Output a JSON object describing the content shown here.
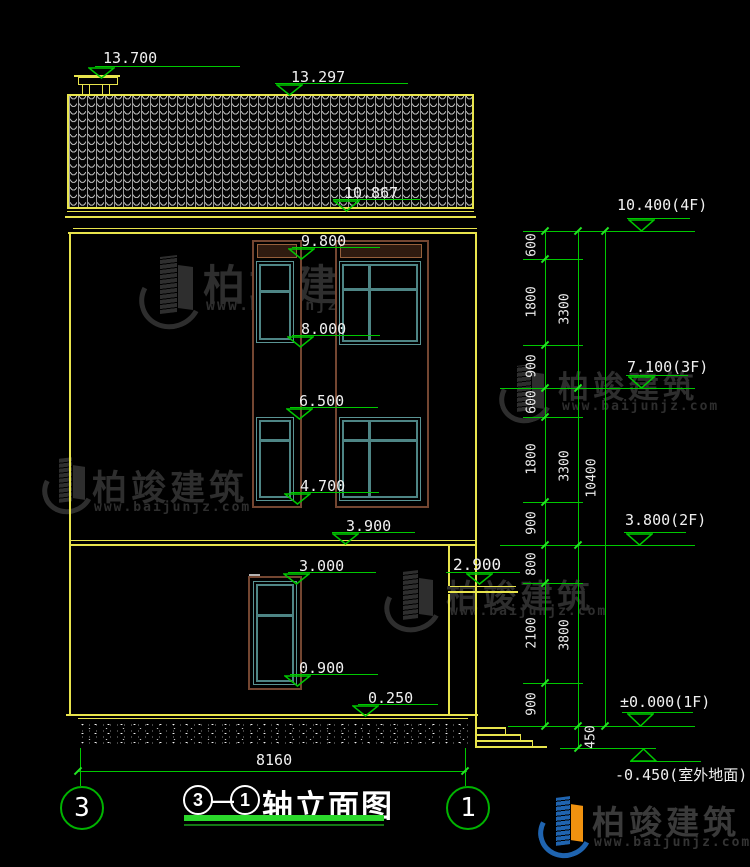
{
  "drawing": {
    "title": {
      "axis_from": "3",
      "separator": "—",
      "axis_to": "1",
      "label": "轴立面图"
    },
    "axis_bubbles": {
      "left": "3",
      "right": "1"
    },
    "overall_width_dim": "8160"
  },
  "left_levels": [
    {
      "name": "chimney-top",
      "value": "13.700"
    },
    {
      "name": "ridge",
      "value": "13.297"
    },
    {
      "name": "eave",
      "value": "10.867"
    },
    {
      "name": "window-top-3f",
      "value": "9.800"
    },
    {
      "name": "window-sill-3f",
      "value": "8.000"
    },
    {
      "name": "window-top-2f",
      "value": "6.500"
    },
    {
      "name": "window-sill-2f",
      "value": "4.700"
    },
    {
      "name": "floor-band",
      "value": "3.900"
    },
    {
      "name": "window-top-1f",
      "value": "3.000"
    },
    {
      "name": "window-sill-1f",
      "value": "0.900"
    },
    {
      "name": "plinth",
      "value": "0.250"
    },
    {
      "name": "canopy",
      "value": "2.900"
    }
  ],
  "right_levels": [
    {
      "value": "10.400(4F)"
    },
    {
      "value": "7.100(3F)"
    },
    {
      "value": "3.800(2F)"
    },
    {
      "value": "±0.000(1F)"
    },
    {
      "value": "-0.450(室外地面)"
    }
  ],
  "inner_dims": [
    "600",
    "1800",
    "900",
    "600",
    "1800",
    "900",
    "800",
    "2100",
    "900"
  ],
  "mid_dims": [
    "3300",
    "3300",
    "3800"
  ],
  "foundation_dim": "450",
  "total_dim": "10400",
  "watermark": {
    "brand": "柏竣建筑",
    "site": "www.baijunjz.com"
  },
  "footer_logo": {
    "brand": "柏竣建筑",
    "site": "www.baijunjz.com"
  },
  "icons": {
    "level-triangle-down": "▽",
    "level-triangle-up": "△",
    "brand-logo": "building-swoosh"
  },
  "colors": {
    "background": "#000000",
    "line_yellow": "#e8e44c",
    "dim_green": "#00c800",
    "tick_green": "#23e623",
    "text_white": "#f0f0f0",
    "window_teal": "#4e8585",
    "frame_brown": "#744631",
    "title_underline": "#2bd82b",
    "logo_blue": "#1f64b0",
    "logo_orange": "#f0920f",
    "watermark_gray": "#2e2e2e"
  }
}
